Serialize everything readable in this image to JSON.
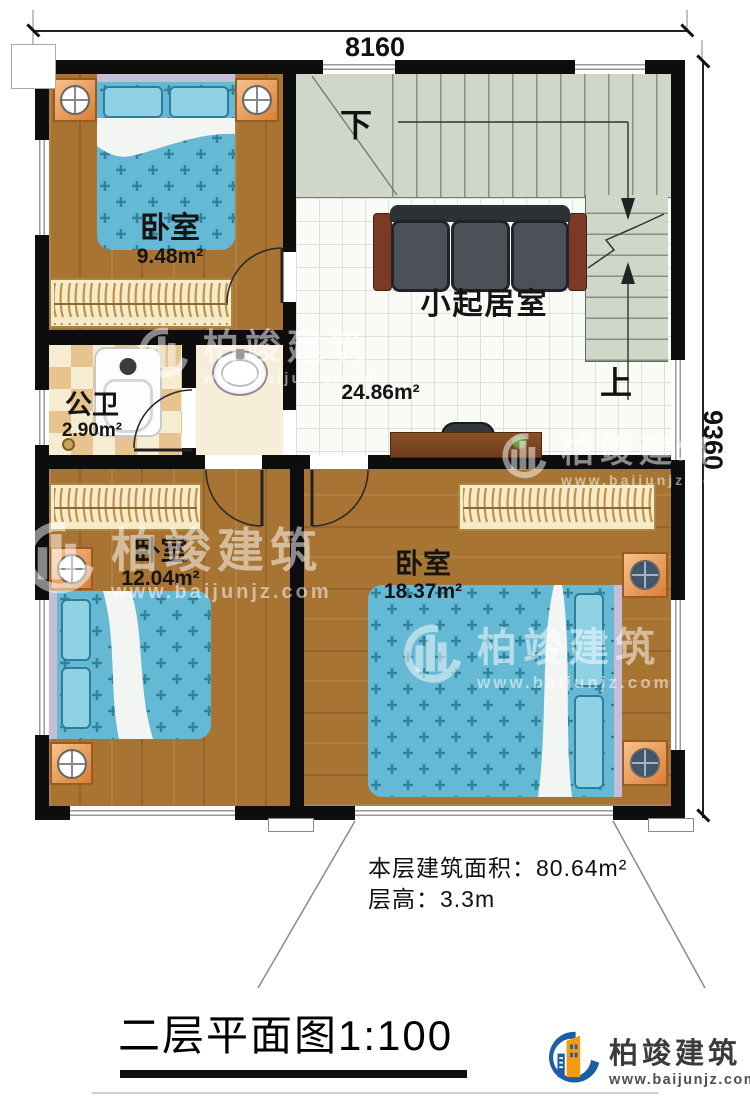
{
  "dimensions": {
    "width": "8160",
    "height": "9360"
  },
  "rooms": [
    {
      "name": "卧室",
      "area": "9.48m²"
    },
    {
      "name": "小起居室",
      "area": "24.86m²"
    },
    {
      "name": "公卫",
      "area": "2.90m²"
    },
    {
      "name": "卧室",
      "area": "12.04m²"
    },
    {
      "name": "卧室",
      "area": "18.37m²"
    }
  ],
  "stairs": {
    "down_label": "下",
    "up_label": "上"
  },
  "notes": {
    "floor_area": "本层建筑面积：80.64m²",
    "floor_height": "层高：3.3m"
  },
  "title": "二层平面图1:100",
  "brand": {
    "name": "柏竣建筑",
    "url": "www.baijunjz.com"
  },
  "watermark": {
    "name": "柏竣建筑",
    "url": "www.baijunjz.com"
  }
}
